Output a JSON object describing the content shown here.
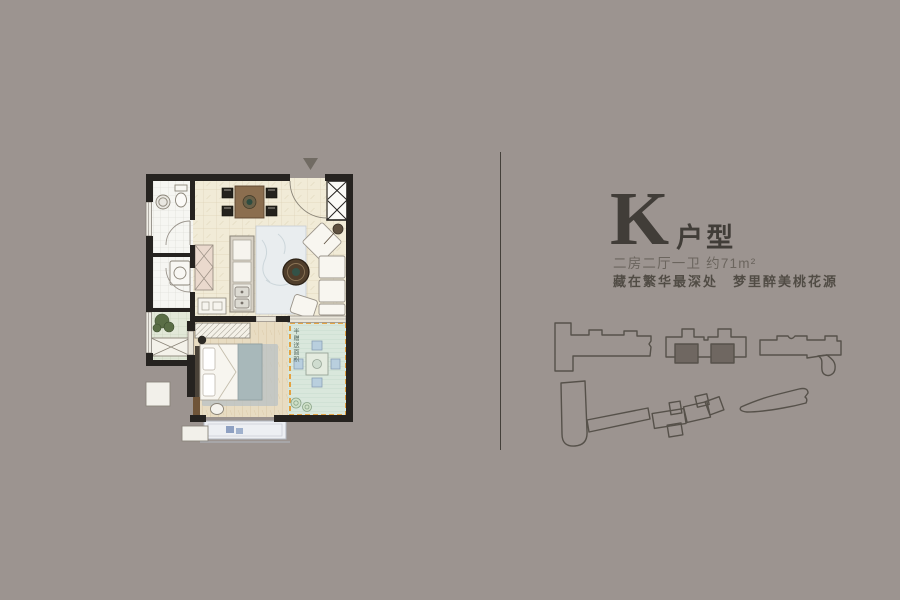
{
  "canvas": {
    "bg_color": "#9c9490"
  },
  "unit": {
    "letter": "K",
    "type_label": "户型",
    "specs": "二房二厅一卫 约71m²",
    "tagline": "藏在繁华最深处　梦里醉美桃花源"
  },
  "floorplan": {
    "terrace_label": "半赠送面积",
    "colors": {
      "wall": "#262320",
      "cream_tile": "#f1ebd7",
      "wood_floor": "#e8dcc2",
      "terrace_deck": "#d9e7dc",
      "terrace_border": "#e59a2f",
      "bath_tile": "#f6f6f2",
      "balcony_tile": "#e2e8d8",
      "living_rug": "#e9edef",
      "bedroom_rug": "#b9c2c4"
    }
  },
  "divider": {
    "color": "#44403a"
  },
  "siteplan": {
    "outline_color": "#56514a",
    "highlight_color": "#6f6761"
  },
  "text_colors": {
    "title": "#413d38",
    "specs": "#6b655e",
    "tagline": "#514c45"
  }
}
